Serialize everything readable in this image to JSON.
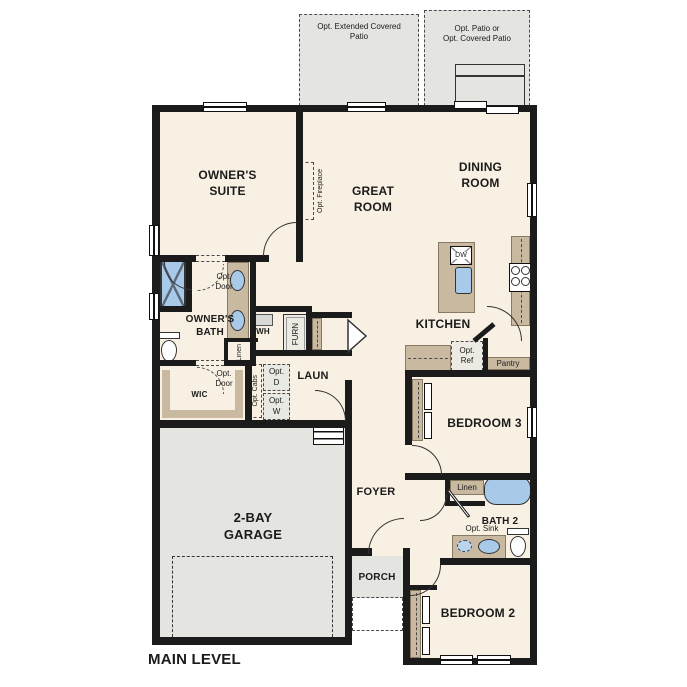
{
  "plan": {
    "title": "MAIN LEVEL",
    "rooms": {
      "owners_suite": "OWNER'S\nSUITE",
      "great_room": "GREAT\nROOM",
      "dining_room": "DINING\nROOM",
      "kitchen": "KITCHEN",
      "owners_bath": "OWNER'S\nBATH",
      "wic": "WIC",
      "laundry": "LAUN",
      "foyer": "FOYER",
      "bedroom_3": "BEDROOM 3",
      "bath_2": "BATH 2",
      "bedroom_2": "BEDROOM 2",
      "porch": "PORCH",
      "garage": "2-BAY\nGARAGE",
      "pantry": "Pantry"
    },
    "optional_features": {
      "extended_covered_patio": "Opt. Extended Covered\nPatio",
      "patio_or_covered_patio": "Opt. Patio or\nOpt. Covered Patio",
      "fireplace": "Opt. Fireplace",
      "bath_door": "Opt.\nDoor",
      "wic_door": "Opt.\nDoor",
      "refrigerator": "Opt.\nRef",
      "cabinets": "Opt. Cabs",
      "dryer": "Opt.\nD",
      "washer": "Opt.\nW",
      "sink": "Opt. Sink"
    },
    "fixtures": {
      "dishwasher": "DW",
      "water_heater": "WH",
      "furnace": "FURN",
      "linen_owners": "Linen",
      "linen_bath2": "Linen"
    },
    "colors": {
      "wall": "#1b1b1b",
      "floor": "#f8f0e3",
      "cabinet": "#c9b9a0",
      "concrete": "#e4e4e1",
      "fixture_blue": "#a9c9e9"
    }
  }
}
